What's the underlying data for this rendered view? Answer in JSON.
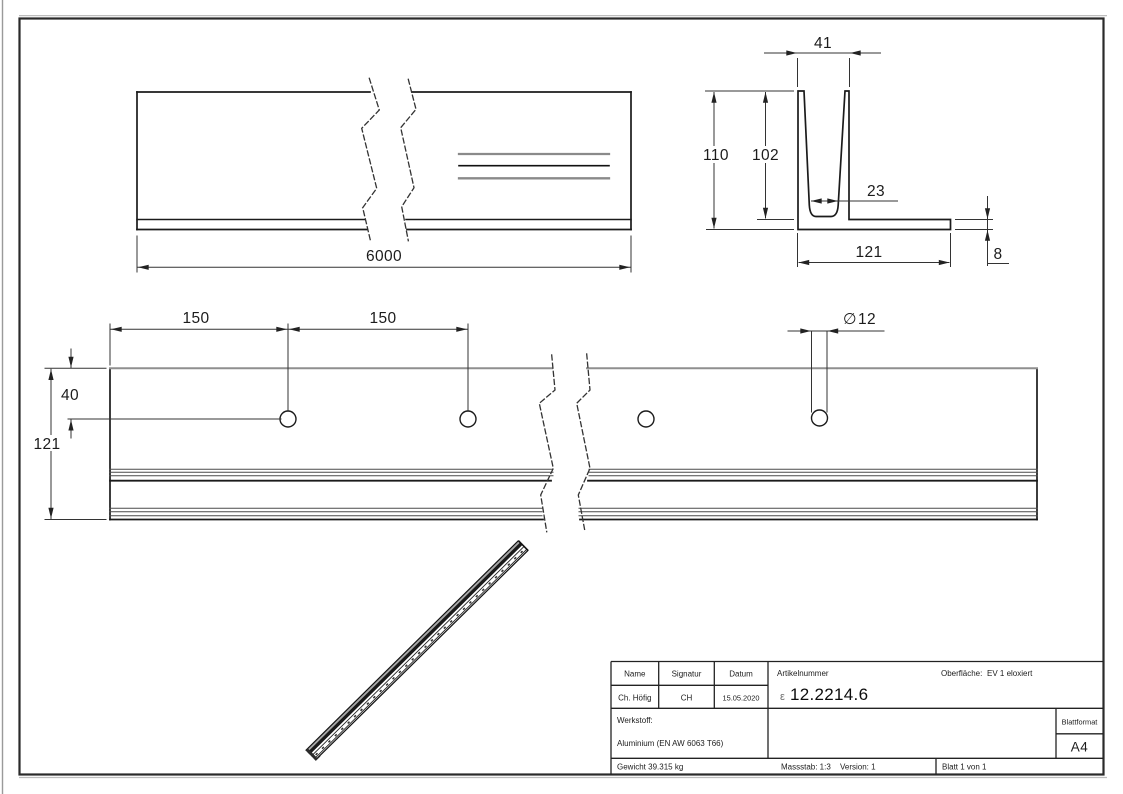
{
  "dimensions": {
    "side_view_length": "6000",
    "cs_top_width": "41",
    "cs_height": "110",
    "cs_inner_depth": "102",
    "cs_slot_bottom_width": "23",
    "cs_base_width": "121",
    "cs_base_thickness": "8",
    "tv_pitch_a": "150",
    "tv_pitch_b": "150",
    "tv_hole_offset": "40",
    "tv_width": "121",
    "tv_hole_dia_symbol": "∅",
    "tv_hole_dia": "12"
  },
  "title_block": {
    "name_label": "Name",
    "signatur_label": "Signatur",
    "datum_label": "Datum",
    "artikelnummer_label": "Artikelnummer",
    "oberflaeche_label": "Oberfläche:",
    "oberflaeche_value": "EV 1 eloxiert",
    "name_value": "Ch. Höfig",
    "signatur_value": "CH",
    "datum_value": "15.05.2020",
    "logo_glyph": "ε",
    "artikelnummer_value": "12.2214.6",
    "werkstoff_label": "Werkstoff:",
    "werkstoff_value": "Aluminium (EN AW 6063 T66)",
    "blattformat_label": "Blattformat",
    "blattformat_value": "A4",
    "gewicht": "Gewicht 39.315 kg",
    "massstab": "Massstab: 1:3",
    "version": "Version: 1",
    "blatt": "Blatt 1 von 1"
  },
  "colors": {
    "line": "#1b1b1b",
    "thin": "#333333",
    "gray_edge": "#8a8a8a",
    "frame": "#2a2a2a"
  }
}
